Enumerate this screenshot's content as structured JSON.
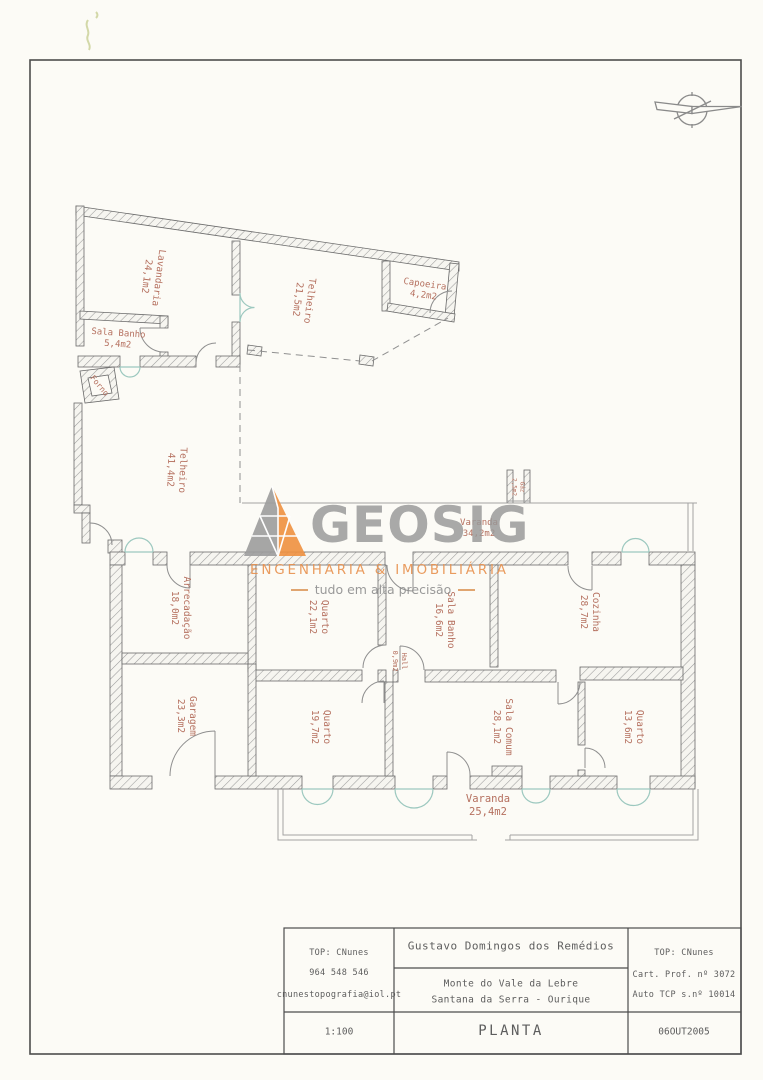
{
  "title_block": {
    "left": {
      "line1": "TOP: CNunes",
      "line2": "964 548 546",
      "line3": "cnunestopografia@iol.pt"
    },
    "center": {
      "client": "Gustavo Domingos dos Remédios",
      "location_line1": "Monte do Vale da Lebre",
      "location_line2": "Santana da Serra - Ourique"
    },
    "right": {
      "line1": "TOP: CNunes",
      "line2": "Cart. Prof. nº 3072",
      "line3": "Auto TCP s.nº 10014"
    },
    "scale": "1:100",
    "drawing_title": "PLANTA",
    "date": "06OUT2005"
  },
  "logo": {
    "name": "GEOSIG",
    "tagline": "ENGENHARIA & IMOBILIÁRIA",
    "slogan": "tudo em alta precisão",
    "orange": "#e8914e",
    "gray": "#989898"
  },
  "colors": {
    "room_label": "#b5705f",
    "window_teal": "#9cc8bf",
    "wall_gray": "#6a6a6a"
  },
  "rooms": [
    {
      "name": "Lavandaria",
      "area": "24,1m2",
      "x": 152,
      "y": 277,
      "rot": 97,
      "size": 9.5
    },
    {
      "name": "Telheiro",
      "area": "21,5m2",
      "x": 303,
      "y": 300,
      "rot": 97,
      "size": 9.5
    },
    {
      "name": "Capoeira",
      "area": "4,2m2",
      "x": 424,
      "y": 291,
      "rot": 8,
      "size": 9
    },
    {
      "name": "Sala Banho",
      "area": "5,4m2",
      "x": 118,
      "y": 340,
      "rot": 4,
      "size": 9
    },
    {
      "name": "Forno",
      "area": "",
      "x": 99,
      "y": 386,
      "rot": 50,
      "size": 8
    },
    {
      "name": "Telheiro",
      "area": "41,4m2",
      "x": 176,
      "y": 470,
      "rot": 92,
      "size": 9.5
    },
    {
      "name": "Arrecadação",
      "area": "18,0m2",
      "x": 180,
      "y": 608,
      "rot": 90,
      "size": 9.5
    },
    {
      "name": "Quarto",
      "area": "22,1m2",
      "x": 318,
      "y": 617,
      "rot": 90,
      "size": 9.5
    },
    {
      "name": "Hall",
      "area": "0,9m2",
      "x": 399,
      "y": 661,
      "rot": 90,
      "size": 7
    },
    {
      "name": "Sala Banho",
      "area": "16,6m2",
      "x": 444,
      "y": 620,
      "rot": 90,
      "size": 9.5
    },
    {
      "name": "Cozinha",
      "area": "28,7m2",
      "x": 589,
      "y": 612,
      "rot": 90,
      "size": 9.5
    },
    {
      "name": "Garagem",
      "area": "23,3m2",
      "x": 186,
      "y": 716,
      "rot": 90,
      "size": 9.5
    },
    {
      "name": "Quarto",
      "area": "19,7m2",
      "x": 320,
      "y": 727,
      "rot": 90,
      "size": 9.5
    },
    {
      "name": "Sala Comum",
      "area": "28,1m2",
      "x": 502,
      "y": 727,
      "rot": 90,
      "size": 9.5
    },
    {
      "name": "Quarto",
      "area": "13,6m2",
      "x": 633,
      "y": 727,
      "rot": 90,
      "size": 9.5
    },
    {
      "name": "Varanda",
      "area": "25,4m2",
      "x": 488,
      "y": 806,
      "rot": 0,
      "size": 10.5
    },
    {
      "name": "Varanda",
      "area": "34,2m2",
      "x": 479,
      "y": 529,
      "rot": 0,
      "size": 9
    },
    {
      "name": "Gáz",
      "area": "2,5m2",
      "x": 518,
      "y": 487,
      "rot": 90,
      "size": 6
    }
  ]
}
